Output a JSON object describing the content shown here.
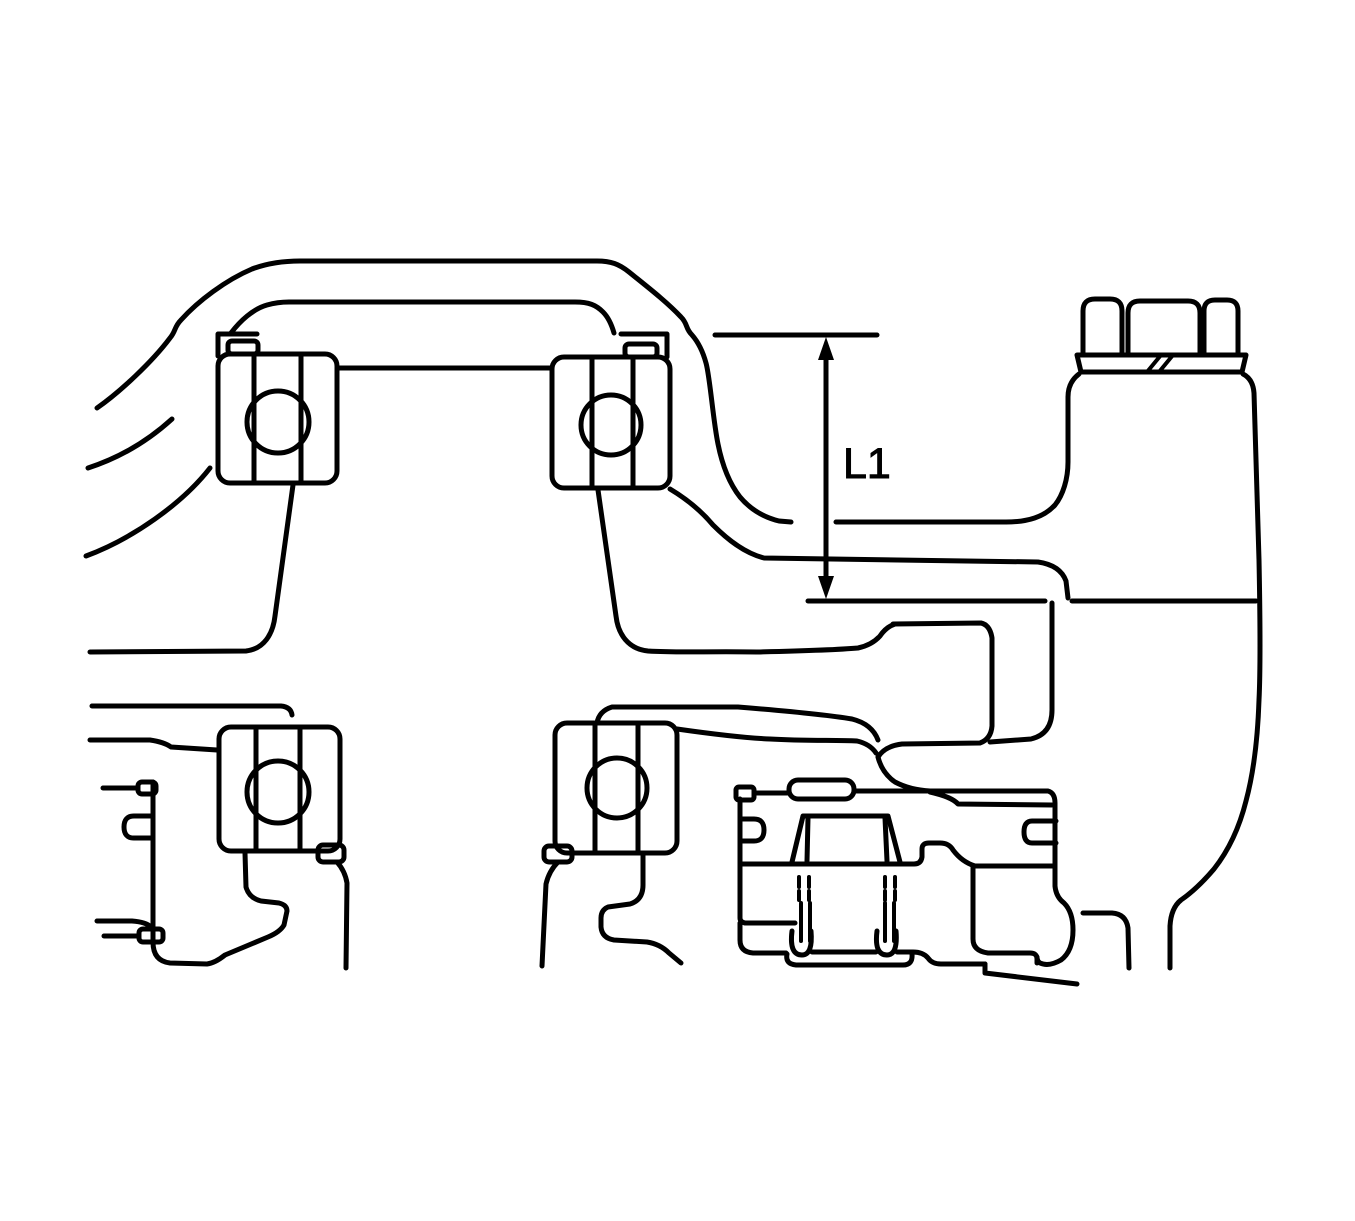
{
  "figure": {
    "dimension_label": "L1"
  },
  "style": {
    "line_color": "#000000",
    "background_color": "#ffffff"
  }
}
